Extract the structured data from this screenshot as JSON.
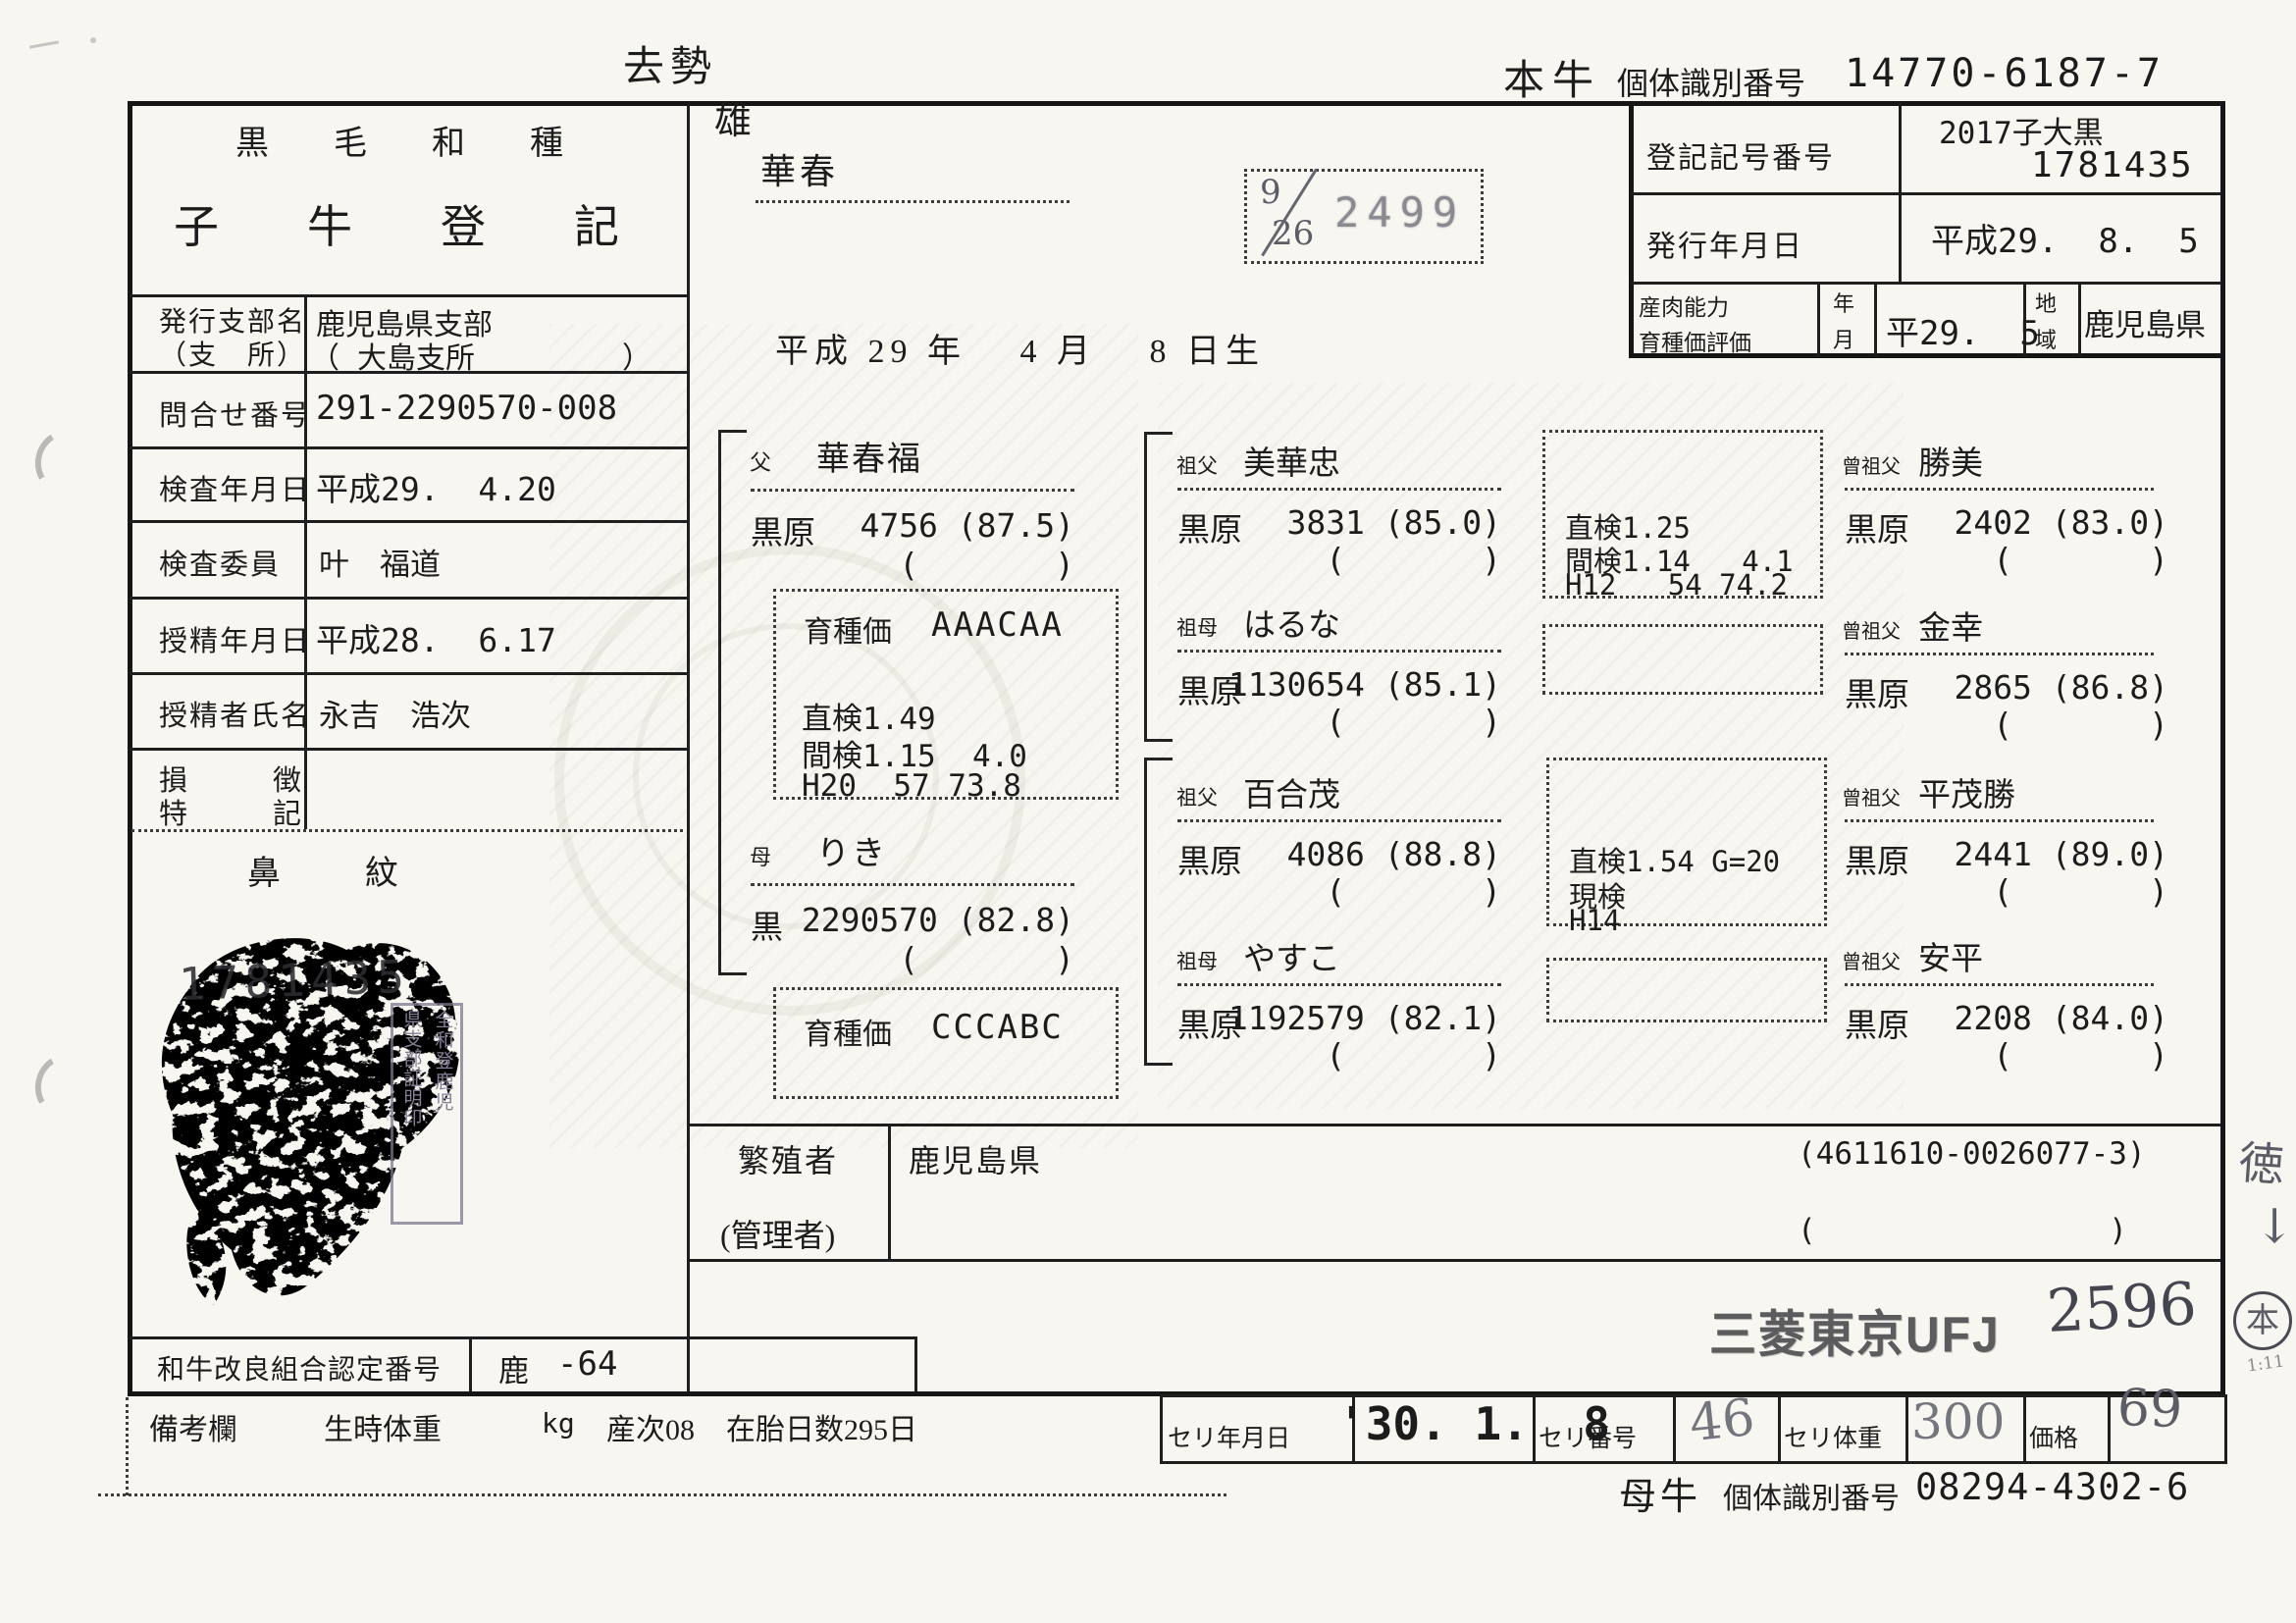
{
  "page": {
    "castration": "去勢",
    "animal_id": {
      "label_main": "本牛",
      "label_sub": "個体識別番号",
      "value": "14770-6187-7"
    }
  },
  "reg_box": {
    "reg_no_label": "登記記号番号",
    "reg_no_line1": "2017子大黒",
    "reg_no_line2": "1781435",
    "issue_date_label": "発行年月日",
    "issue_date": "平成29.  8.  5",
    "ability_label1": "産肉能力",
    "ability_label2": "育種価評価",
    "ym_label1": "年",
    "ym_label2": "月",
    "eval_date": "平29.  5",
    "region_label1": "地",
    "region_label2": "域",
    "region": "鹿児島県"
  },
  "left": {
    "breed_title": "黒　毛　和　種",
    "doc_title": "子　牛　登　記",
    "rows": [
      {
        "label": "発行支部名",
        "label2": "（支　所）",
        "value": "鹿児島県支部",
        "value2": "（ 大島支所　　　　　）"
      },
      {
        "label": "問合せ番号",
        "value": "291-2290570-008"
      },
      {
        "label": "検査年月日",
        "value": "平成29.  4.20"
      },
      {
        "label": "検査委員",
        "value": "叶　福道"
      },
      {
        "label": "授精年月日",
        "value": "平成28.  6.17"
      },
      {
        "label": "授精者氏名",
        "value": "永吉　浩次"
      },
      {
        "label": "損　　　徴",
        "label2": "特　　　記",
        "value": ""
      }
    ],
    "nose_label": "鼻　紋",
    "nose_number": "1781435",
    "cert_stamp_col1": "全和登鹿児",
    "cert_stamp_col2": "県支部証明印",
    "union_label": "和牛改良組合認定番号",
    "union_pref": "鹿",
    "union_no": "-64"
  },
  "calf": {
    "sex": "雄",
    "name": "華春",
    "stamp_top": "9",
    "stamp_bottom": "26",
    "stamp_number": "2499",
    "birth_date": "平成 29 年　 4 月　 8 日生"
  },
  "pedigree": {
    "father": {
      "rel": "父",
      "name": "華春福",
      "reg": "黒原",
      "num": "4756 (87.5)",
      "paren": "(       )",
      "ev_title": "育種価",
      "ev_grade": "AAACAA",
      "ev_lines": [
        "直検1.49",
        "間検1.15  4.0",
        "H20  57 73.8"
      ]
    },
    "mother": {
      "rel": "母",
      "name": "りき",
      "reg": "黒",
      "num": "2290570 (82.8)",
      "paren": "(       )",
      "ev_title": "育種価",
      "ev_grade": "CCCABC"
    },
    "gp": [
      {
        "rel": "祖父",
        "name": "美華忠",
        "reg": "黒原",
        "num": "3831 (85.0)",
        "paren": "(       )"
      },
      {
        "rel": "祖母",
        "name": "はるな",
        "reg": "黒原",
        "num": "1130654 (85.1)",
        "paren": "(       )"
      },
      {
        "rel": "祖父",
        "name": "百合茂",
        "reg": "黒原",
        "num": "4086 (88.8)",
        "paren": "(       )"
      },
      {
        "rel": "祖母",
        "name": "やすこ",
        "reg": "黒原",
        "num": "1192579 (82.1)",
        "paren": "(       )"
      }
    ],
    "eval_boxes": {
      "box1": [
        "直検1.25",
        "間検1.14   4.1",
        "H12   54 74.2"
      ],
      "box3": [
        "直検1.54 G=20",
        "現検",
        "H14"
      ]
    },
    "ggp": [
      {
        "rel": "曾祖父",
        "name": "勝美",
        "reg": "黒原",
        "num": "2402 (83.0)",
        "paren": "(       )"
      },
      {
        "rel": "曾祖父",
        "name": "金幸",
        "reg": "黒原",
        "num": "2865 (86.8)",
        "paren": "(       )"
      },
      {
        "rel": "曾祖父",
        "name": "平茂勝",
        "reg": "黒原",
        "num": "2441 (89.0)",
        "paren": "(       )"
      },
      {
        "rel": "曾祖父",
        "name": "安平",
        "reg": "黒原",
        "num": "2208 (84.0)",
        "paren": "(       )"
      }
    ]
  },
  "breeder": {
    "label1": "繁殖者",
    "label2": "(管理者)",
    "name": "鹿児島県",
    "code1": "(4611610-0026077-3)",
    "code2": "(                )"
  },
  "stamps": {
    "bank": "三菱東京UFJ",
    "hand_no": "2596",
    "margin_text": "徳",
    "margin_arrow": "↓",
    "margin_circled": "本",
    "margin_small": "1:11"
  },
  "bottom": {
    "remarks_label": "備考欄",
    "birth_weight_label": "生時体重",
    "unit": "kg",
    "parity": "産次08",
    "gestation": "在胎日数295日",
    "auction_date_label": "セリ年月日",
    "auction_date": "'30. 1.  8",
    "auction_no_label": "セリ番号",
    "auction_no": "46",
    "auction_weight_label": "セリ体重",
    "auction_weight": "300",
    "price_label": "価格",
    "price": "69",
    "dam_label_main": "母牛",
    "dam_label_sub": "個体識別番号",
    "dam_id": "08294-4302-6"
  }
}
